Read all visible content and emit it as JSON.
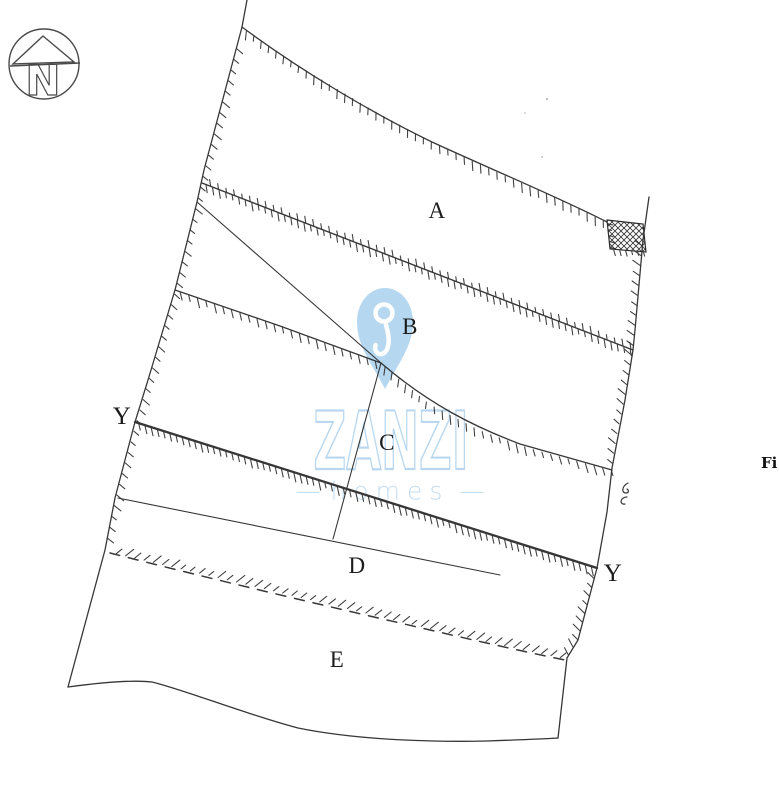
{
  "compass": {
    "letter": "N"
  },
  "watermark": {
    "brand": "ZANZI",
    "tagline": "homes",
    "dash": "—",
    "pin_color": "#b5d8f0",
    "outline_color": "#b9d8f0",
    "tagline_color": "#c3ddf2"
  },
  "parcels": {
    "a": "A",
    "b": "B",
    "c": "C",
    "d": "D",
    "e": "E"
  },
  "markers": {
    "y_left": "Y",
    "y_right": "Y"
  },
  "edge_text": {
    "fi": "Fi"
  },
  "colors": {
    "ink": "#2d2d2d"
  }
}
